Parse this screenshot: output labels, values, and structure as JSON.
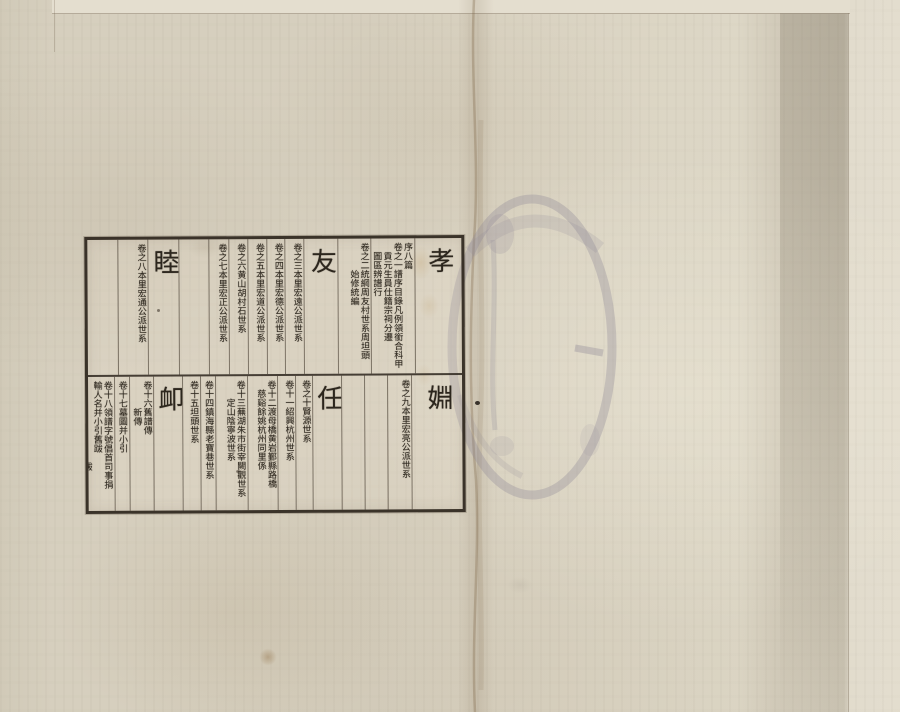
{
  "colors": {
    "paper": "#d8d1c0",
    "ink": "#2c261d",
    "seal": "#8d8696",
    "crease": "#7d6443",
    "grid_line": "#3e3428"
  },
  "seal": {
    "glyph_name": "faded-circular-stamp"
  },
  "table": {
    "rows": [
      {
        "columns": [
          {
            "kind": "section",
            "w": 47,
            "lines": [
              {
                "t": "孝",
                "ind": 0
              }
            ]
          },
          {
            "kind": "entry",
            "w": 43,
            "lines": [
              {
                "t": "序八篇",
                "ind": 0
              },
              {
                "t": "卷之一譜序目錄凡例領銜合科甲",
                "ind": 0
              },
              {
                "t": "貢元生員仕籍宗祠分遷",
                "ind": 1
              },
              {
                "t": "圖區辨譜行",
                "ind": 1
              }
            ]
          },
          {
            "kind": "entry",
            "w": 33,
            "lines": [
              {
                "t": "卷之二統綱周友村世系周坦頭",
                "ind": 0
              },
              {
                "t": "始修統編",
                "ind": 3
              }
            ]
          },
          {
            "kind": "section",
            "w": 33,
            "lines": [
              {
                "t": "友",
                "ind": 0
              }
            ]
          },
          {
            "kind": "entry",
            "w": 18,
            "lines": [
              {
                "t": "卷之三本里宏遠公派世系",
                "ind": 0
              }
            ]
          },
          {
            "kind": "entry",
            "w": 18,
            "lines": [
              {
                "t": "卷之四本里宏德公派世系",
                "ind": 0
              }
            ]
          },
          {
            "kind": "entry",
            "w": 18,
            "lines": [
              {
                "t": "卷之五本里宏道公派世系",
                "ind": 0
              }
            ]
          },
          {
            "kind": "entry",
            "w": 18,
            "lines": [
              {
                "t": "卷之六黄山胡村石世系",
                "ind": 0
              }
            ]
          },
          {
            "kind": "entry",
            "w": 19,
            "lines": [
              {
                "t": "卷之七本里宏正公派世系",
                "ind": 0
              }
            ]
          },
          {
            "kind": "empty",
            "w": 30,
            "lines": []
          },
          {
            "kind": "section",
            "w": 30,
            "lines": [
              {
                "t": "睦",
                "ind": 0
              }
            ]
          },
          {
            "kind": "entry",
            "w": 30,
            "lines": [
              {
                "t": "卷之八本里宏通公派世系",
                "ind": 0
              }
            ]
          },
          {
            "kind": "empty",
            "w": 30,
            "lines": []
          }
        ]
      },
      {
        "columns": [
          {
            "kind": "section",
            "w": 50,
            "lines": [
              {
                "t": "婣",
                "ind": 0
              }
            ]
          },
          {
            "kind": "entry",
            "w": 24,
            "lines": [
              {
                "t": "卷之九本里宏亮公派世系",
                "ind": 0
              }
            ]
          },
          {
            "kind": "empty",
            "w": 22,
            "lines": []
          },
          {
            "kind": "empty",
            "w": 22,
            "lines": []
          },
          {
            "kind": "section",
            "w": 28,
            "lines": [
              {
                "t": "任",
                "ind": 0
              }
            ]
          },
          {
            "kind": "entry",
            "w": 16,
            "lines": [
              {
                "t": "卷之十賢源世系",
                "ind": 0
              }
            ]
          },
          {
            "kind": "entry",
            "w": 17,
            "lines": [
              {
                "t": "卷十一紹興杭州世系",
                "ind": 0
              }
            ]
          },
          {
            "kind": "entry",
            "w": 30,
            "lines": [
              {
                "t": "卷十二渡母橋黄岩鄞縣路橋",
                "ind": 0
              },
              {
                "t": "慈谿餘姚杭州同里係",
                "ind": 1
              }
            ]
          },
          {
            "kind": "entry",
            "w": 31,
            "lines": [
              {
                "t": "卷十三蕪湖朱市街宰闕觀世系",
                "ind": 0
              },
              {
                "t": "定山陰寧波世系",
                "ind": 2
              }
            ]
          },
          {
            "kind": "entry",
            "w": 14,
            "lines": [
              {
                "t": "卷十四鎮海縣老寶巷世系",
                "ind": 0
              }
            ]
          },
          {
            "kind": "entry",
            "w": 17,
            "lines": [
              {
                "t": "卷十五坦頭世系",
                "ind": 0
              }
            ]
          },
          {
            "kind": "section",
            "w": 28,
            "lines": [
              {
                "t": "卹",
                "ind": 0
              }
            ]
          },
          {
            "kind": "entry",
            "w": 24,
            "lines": [
              {
                "t": "卷十六舊譜傳",
                "ind": 0
              },
              {
                "t": "新傳",
                "ind": 3
              }
            ]
          },
          {
            "kind": "entry",
            "w": 14,
            "lines": [
              {
                "t": "卷十七墓圖并小引",
                "ind": 0
              }
            ]
          },
          {
            "kind": "entry",
            "w": 26,
            "lines": [
              {
                "t": "卷十八領譜字號倡首司事捐",
                "ind": 0
              },
              {
                "t": "輸人名并小引舊跋",
                "ind": 0
              },
              {
                "t": "跋",
                "ind": 9
              }
            ]
          }
        ]
      }
    ]
  }
}
